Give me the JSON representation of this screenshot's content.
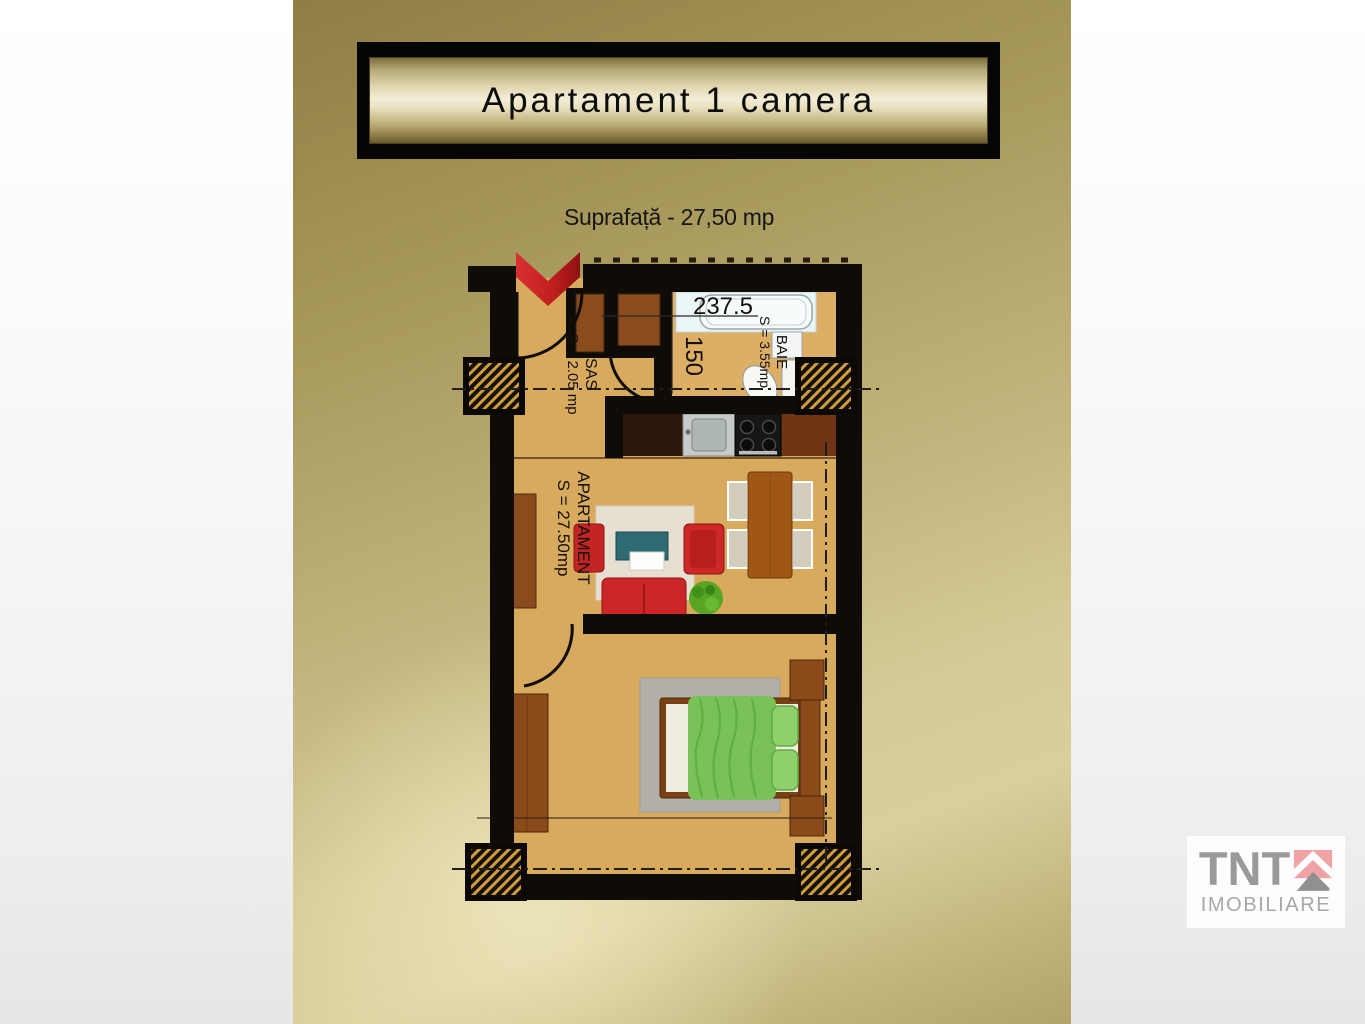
{
  "title": {
    "label": "Apartament 1 camera"
  },
  "subtitle": {
    "label": "Suprafață - 27,50 mp"
  },
  "floorplan": {
    "dimensions": {
      "width": "237.5",
      "depth": "150"
    },
    "rooms": [
      {
        "name": "SAS",
        "area": "S = 2.05 mp"
      },
      {
        "name": "BAIE",
        "area": "S = 3.55mp"
      },
      {
        "name": "APARTAMENT",
        "area": "S = 27.50mp"
      }
    ]
  },
  "logo": {
    "brand": "TNT",
    "tagline": "IMOBILIARE"
  },
  "colors": {
    "gold_top": "#93834a",
    "gold_light": "#d9cf9d",
    "wall_black": "#0f0b06",
    "floor_tan": "#d7aa5e",
    "entry_red": "#c32020",
    "sofa_red": "#cc2626",
    "table_teal": "#2e6a72",
    "bed_green": "#79c257",
    "wood_brown": "#8a4a1a",
    "logo_pink": "#f0a3a4",
    "logo_gray": "#9a9a9a"
  }
}
